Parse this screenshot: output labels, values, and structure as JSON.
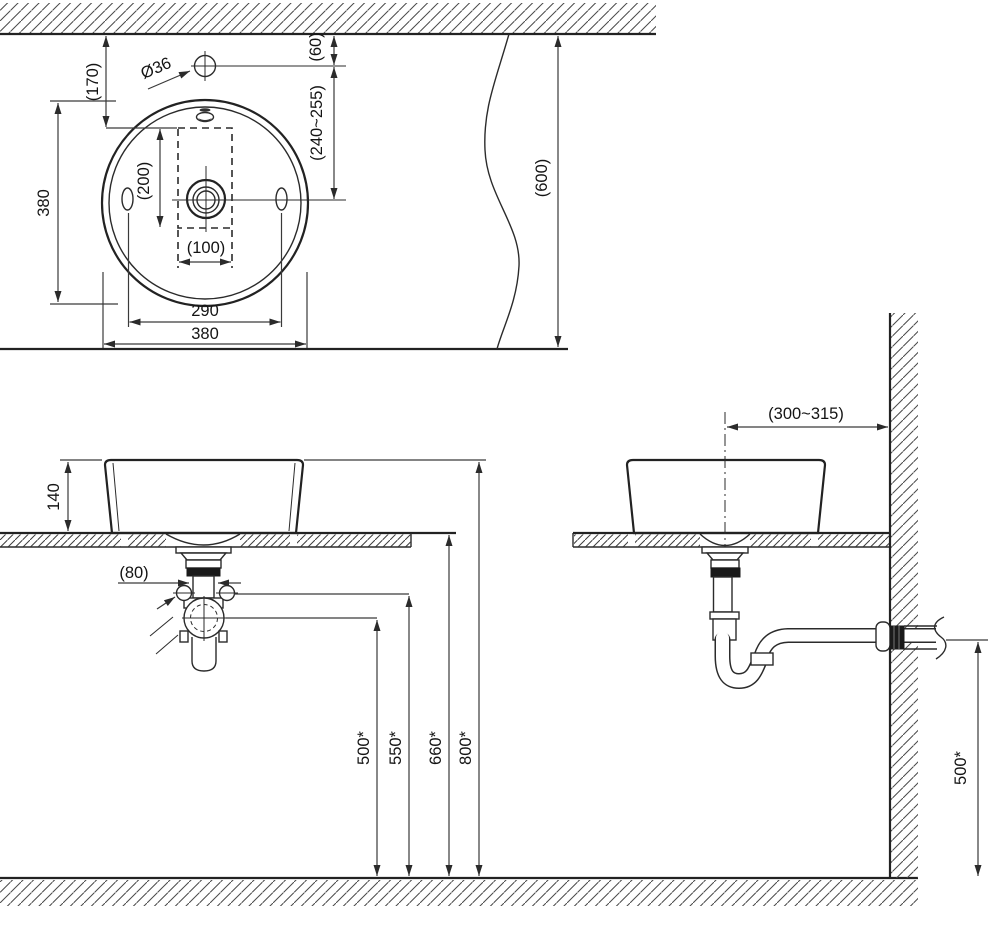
{
  "colors": {
    "line": "#2b2b2b",
    "background": "#ffffff"
  },
  "plan_view": {
    "wall_offset_label": "(170)",
    "faucet_hole_diameter_label": "Ø36",
    "faucet_to_wall_label": "(60)",
    "faucet_to_drain_label": "(240~255)",
    "basin_diameter_side_label": "380",
    "cutout_length_label": "(200)",
    "cutout_width_label": "(100)",
    "hole_spacing_label": "290",
    "basin_diameter_bottom_label": "380",
    "counter_depth_label": "(600)"
  },
  "front_view": {
    "basin_height_label": "140",
    "drain_diameter_label": "(80)",
    "heights": [
      "500*",
      "550*",
      "660*",
      "800*"
    ]
  },
  "side_view": {
    "wall_distance_label": "(300~315)",
    "outlet_height_label": "500*"
  }
}
